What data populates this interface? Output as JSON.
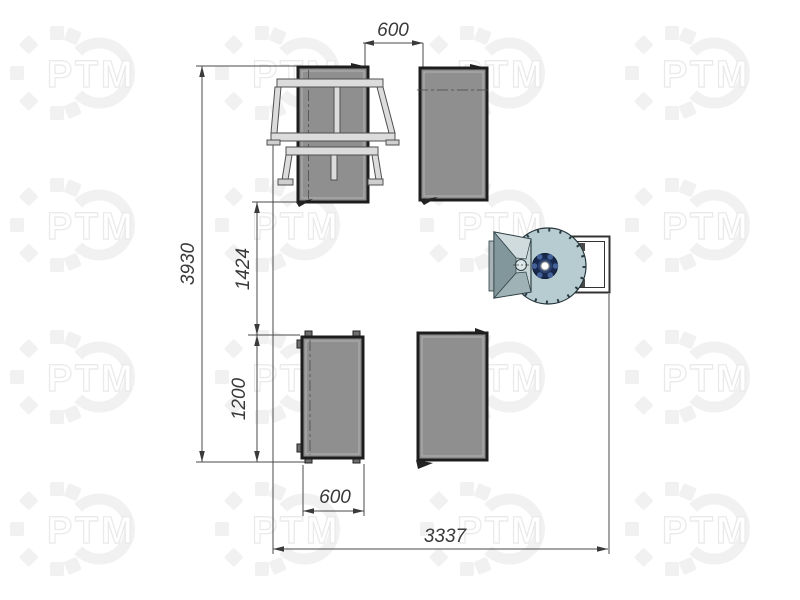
{
  "watermark": {
    "text": "РТМ"
  },
  "drawing": {
    "kind": "equipment-layout-plan-top-view",
    "dimensions": {
      "top_gap": "600",
      "overall_depth": "3930",
      "row_spacing": "1424",
      "table_depth": "1200",
      "bottom_gap": "600",
      "overall_width": "3337"
    },
    "colors": {
      "machine_fill": "#8f8f8f",
      "machine_border": "#1d1d1d",
      "frame_fill": "#dcdcdc",
      "disc_fill": "#b6ccd1",
      "hub_navy": "#18294d",
      "hopper_light": "#c9d6d8",
      "hopper_dark": "#81979b",
      "dim_line": "#4a4a4a",
      "watermark_gray": "#f1f1f1"
    }
  }
}
